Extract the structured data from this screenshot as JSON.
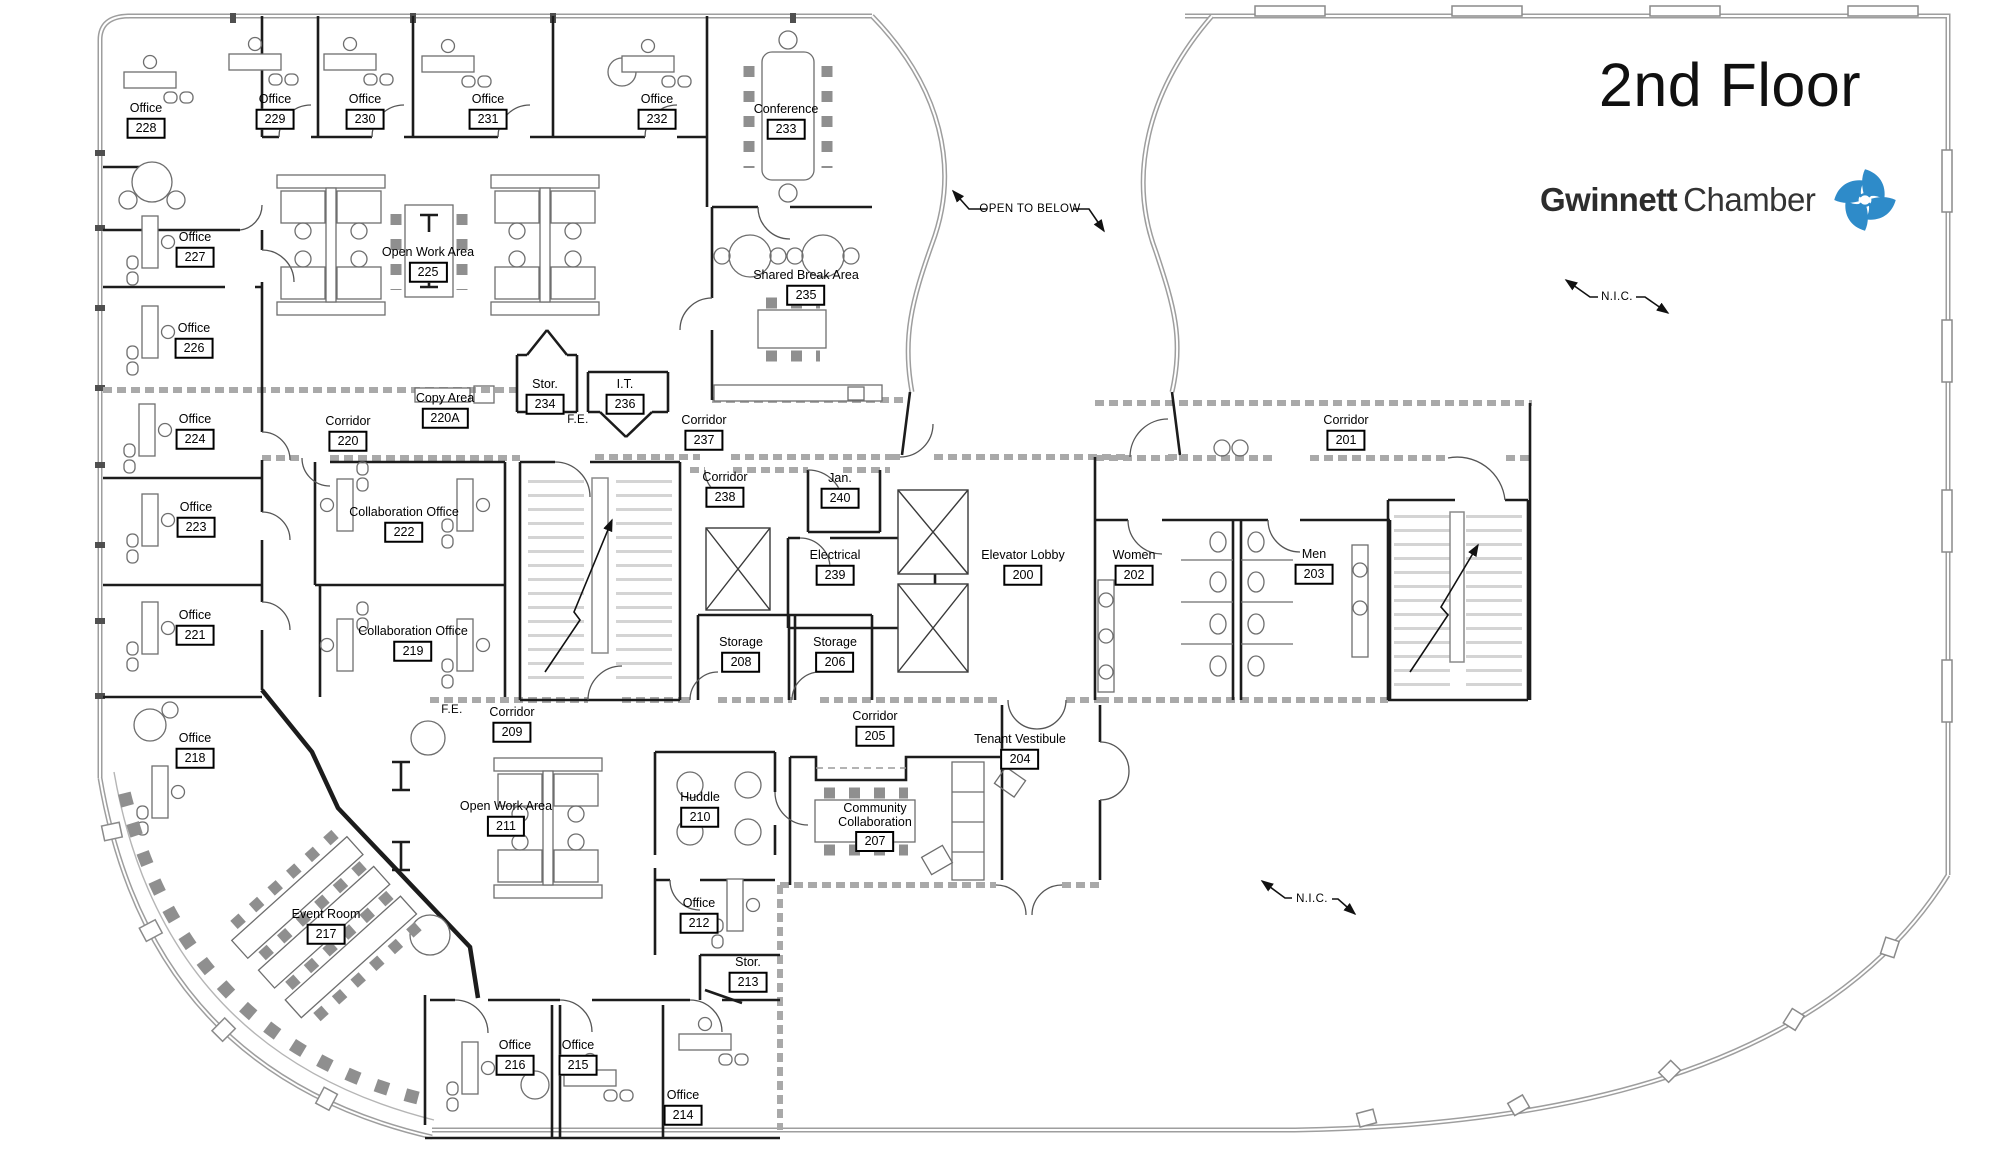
{
  "title": "2nd Floor",
  "brand": {
    "name_bold": "Gwinnett",
    "name_light": "Chamber",
    "logo_color": "#2e8bc9"
  },
  "colors": {
    "walls": "#1c1c1c",
    "shell": "#9e9e9e",
    "brand_blue": "#2e8bc9"
  },
  "annotations": [
    {
      "text": "OPEN TO BELOW",
      "x": 1030,
      "y": 209
    },
    {
      "text": "N.I.C.",
      "x": 1617,
      "y": 297
    },
    {
      "text": "N.I.C.",
      "x": 1312,
      "y": 899
    },
    {
      "text": "F.E.",
      "x": 578,
      "y": 420
    },
    {
      "text": "F.E.",
      "x": 452,
      "y": 710
    }
  ],
  "rooms": [
    {
      "name": "Office",
      "number": "228",
      "x": 146,
      "y": 120
    },
    {
      "name": "Office",
      "number": "229",
      "x": 275,
      "y": 111
    },
    {
      "name": "Office",
      "number": "230",
      "x": 365,
      "y": 111
    },
    {
      "name": "Office",
      "number": "231",
      "x": 488,
      "y": 111
    },
    {
      "name": "Office",
      "number": "232",
      "x": 657,
      "y": 111
    },
    {
      "name": "Conference",
      "number": "233",
      "x": 786,
      "y": 121
    },
    {
      "name": "Office",
      "number": "227",
      "x": 195,
      "y": 249
    },
    {
      "name": "Open Work Area",
      "number": "225",
      "x": 428,
      "y": 264
    },
    {
      "name": "Shared Break Area",
      "number": "235",
      "x": 806,
      "y": 287
    },
    {
      "name": "Office",
      "number": "226",
      "x": 194,
      "y": 340
    },
    {
      "name": "Stor.",
      "number": "234",
      "x": 545,
      "y": 396
    },
    {
      "name": "I.T.",
      "number": "236",
      "x": 625,
      "y": 396
    },
    {
      "name": "Copy Area",
      "number": "220A",
      "x": 445,
      "y": 410
    },
    {
      "name": "Corridor",
      "number": "220",
      "x": 348,
      "y": 433
    },
    {
      "name": "Corridor",
      "number": "237",
      "x": 704,
      "y": 432
    },
    {
      "name": "Office",
      "number": "224",
      "x": 195,
      "y": 431
    },
    {
      "name": "Corridor",
      "number": "238",
      "x": 725,
      "y": 489
    },
    {
      "name": "Jan.",
      "number": "240",
      "x": 840,
      "y": 490
    },
    {
      "name": "Corridor",
      "number": "201",
      "x": 1346,
      "y": 432
    },
    {
      "name": "Office",
      "number": "223",
      "x": 196,
      "y": 519
    },
    {
      "name": "Collaboration Office",
      "number": "222",
      "x": 404,
      "y": 524
    },
    {
      "name": "Electrical",
      "number": "239",
      "x": 835,
      "y": 567
    },
    {
      "name": "Elevator Lobby",
      "number": "200",
      "x": 1023,
      "y": 567
    },
    {
      "name": "Women",
      "number": "202",
      "x": 1134,
      "y": 567
    },
    {
      "name": "Men",
      "number": "203",
      "x": 1314,
      "y": 566
    },
    {
      "name": "Office",
      "number": "221",
      "x": 195,
      "y": 627
    },
    {
      "name": "Collaboration Office",
      "number": "219",
      "x": 413,
      "y": 643
    },
    {
      "name": "Storage",
      "number": "208",
      "x": 741,
      "y": 654
    },
    {
      "name": "Storage",
      "number": "206",
      "x": 835,
      "y": 654
    },
    {
      "name": "Corridor",
      "number": "209",
      "x": 512,
      "y": 724
    },
    {
      "name": "Corridor",
      "number": "205",
      "x": 875,
      "y": 728
    },
    {
      "name": "Office",
      "number": "218",
      "x": 195,
      "y": 750
    },
    {
      "name": "Tenant Vestibule",
      "number": "204",
      "x": 1020,
      "y": 751
    },
    {
      "name": "Huddle",
      "number": "210",
      "x": 700,
      "y": 809
    },
    {
      "name": "Open Work Area",
      "number": "211",
      "x": 506,
      "y": 818
    },
    {
      "name": "Community\nCollaboration",
      "number": "207",
      "x": 875,
      "y": 827
    },
    {
      "name": "Office",
      "number": "212",
      "x": 699,
      "y": 915
    },
    {
      "name": "Event Room",
      "number": "217",
      "x": 326,
      "y": 926
    },
    {
      "name": "Stor.",
      "number": "213",
      "x": 748,
      "y": 974
    },
    {
      "name": "Office",
      "number": "216",
      "x": 515,
      "y": 1057
    },
    {
      "name": "Office",
      "number": "215",
      "x": 578,
      "y": 1057
    },
    {
      "name": "Office",
      "number": "214",
      "x": 683,
      "y": 1107
    }
  ]
}
